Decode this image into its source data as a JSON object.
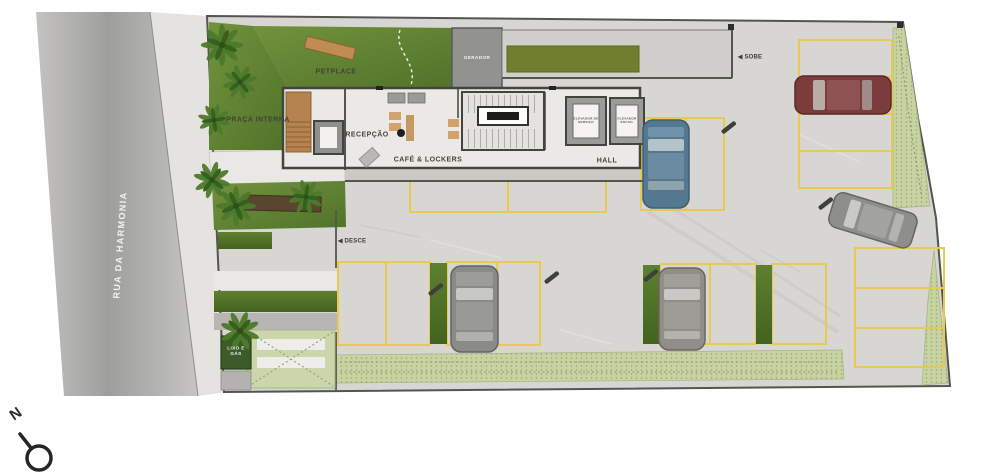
{
  "plan": {
    "street_label": "RUA DA HARMONIA",
    "areas": {
      "petplace": "PETPLACE",
      "praca_interna": "PRAÇA INTERNA",
      "gerador": "GERADOR",
      "lixo_gas": "LIXO E GÁS"
    },
    "rooms": {
      "recepcao": "RECEPÇÃO",
      "cafe_lockers": "CAFÉ & LOCKERS",
      "hall": "HALL",
      "elevador_servico": "ELEVADOR DE SERVIÇO",
      "elevador_social": "ELEVADOR SOCIAL"
    },
    "ramps": {
      "arrow_glyph": "◀",
      "sobe": "SOBE",
      "desce": "DESCE"
    },
    "compass": {
      "north": "N"
    },
    "colors": {
      "road": "#a8a7a5",
      "pavement": "#d7d6d2",
      "grass": "#5d7f33",
      "hedge": "#c8d3a2",
      "parking_lines": "#e8c952",
      "walls": "#4a4a46",
      "car_red": "#7d3c3c",
      "car_blue": "#54788f",
      "car_gray": "#8e8e8c",
      "wood": "#b5834e",
      "lixo_box": "#3d5a2b"
    }
  }
}
